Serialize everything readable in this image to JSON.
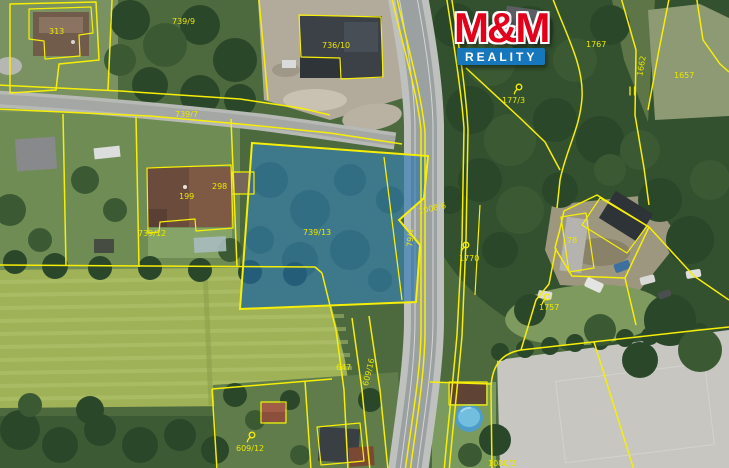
{
  "logo": {
    "mm": "M&M",
    "reality": "REALITY"
  },
  "colors": {
    "line": "#f6ee08",
    "highlight": "#1e6fb0",
    "label": "#ebe700",
    "logo_red": "#e2001a",
    "logo_blue": "#1777bd"
  },
  "labels": {
    "p313": "313",
    "p739_9": "739/9",
    "p736_10": "736/10",
    "p739_7": "739/7",
    "p298": "298",
    "p199": "199",
    "p739_12": "739/12",
    "p739_13": "739/13",
    "p79_4": "79/4",
    "p1008_6": "1008/6",
    "p177_3": "177/3",
    "p1767": "1767",
    "p1662": "1662",
    "p1657": "1657",
    "p78": "78",
    "p1770": "1770",
    "p1757": "1757",
    "p609_16": "609/16",
    "p647": "647",
    "p609_12": "609/12",
    "p1080_2": "1080/2"
  }
}
